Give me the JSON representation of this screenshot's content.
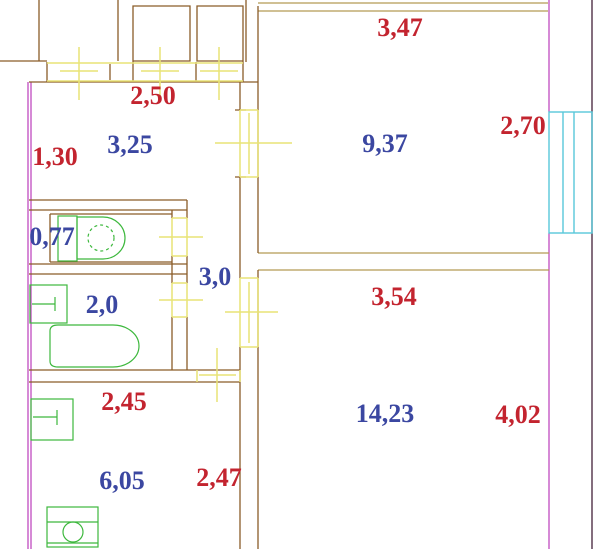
{
  "drawing": {
    "kind": "apartment floor plan (CAD screenshot)",
    "rooms_count": 7
  },
  "colors": {
    "bg": "#ffffff",
    "wall": "#8a5c28",
    "tan": "#b59a55",
    "magenta": "#bb3cbb",
    "yellow": "#e9e476",
    "green": "#3db83d",
    "cyan": "#58c8da",
    "dark": "#503048",
    "red": "#c3242f",
    "blue": "#3b47a1"
  },
  "labels": [
    {
      "text": "2,50",
      "color": "red",
      "x": 153,
      "y": 96
    },
    {
      "text": "3,47",
      "color": "red",
      "x": 400,
      "y": 28
    },
    {
      "text": "1,30",
      "color": "red",
      "x": 55,
      "y": 157
    },
    {
      "text": "2,70",
      "color": "red",
      "x": 523,
      "y": 126
    },
    {
      "text": "3,25",
      "color": "blue",
      "x": 130,
      "y": 145
    },
    {
      "text": "9,37",
      "color": "blue",
      "x": 385,
      "y": 144
    },
    {
      "text": "0,77",
      "color": "blue",
      "x": 52,
      "y": 237
    },
    {
      "text": "3,0",
      "color": "blue",
      "x": 215,
      "y": 277
    },
    {
      "text": "2,0",
      "color": "blue",
      "x": 102,
      "y": 305
    },
    {
      "text": "3,54",
      "color": "red",
      "x": 394,
      "y": 297
    },
    {
      "text": "2,45",
      "color": "red",
      "x": 124,
      "y": 402
    },
    {
      "text": "14,23",
      "color": "blue",
      "x": 385,
      "y": 414
    },
    {
      "text": "4,02",
      "color": "red",
      "x": 518,
      "y": 415
    },
    {
      "text": "6,05",
      "color": "blue",
      "x": 122,
      "y": 481
    },
    {
      "text": "2,47",
      "color": "red",
      "x": 219,
      "y": 478
    }
  ],
  "fixtures": [
    "toilet",
    "bathtub",
    "washbasin",
    "kitchen-sink",
    "stove",
    "window"
  ]
}
